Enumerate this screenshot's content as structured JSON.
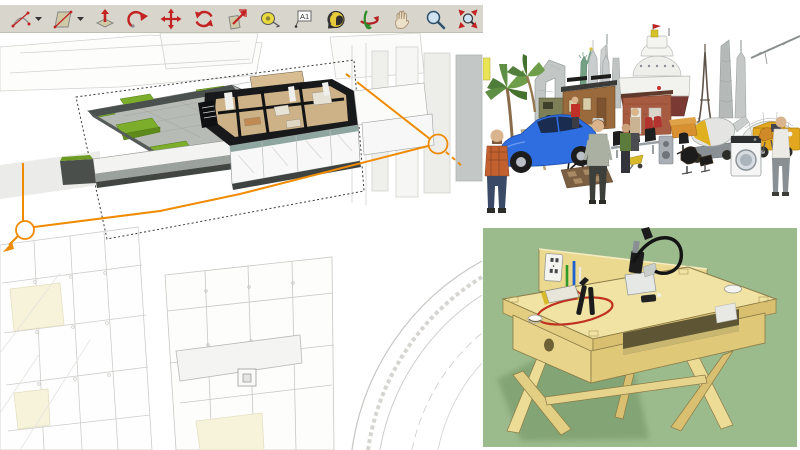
{
  "window": {
    "width": 800,
    "height": 450,
    "background": "#ffffff"
  },
  "left_panel": {
    "toolbar": {
      "background": "#d8d5cd",
      "text_tool_label": "A1",
      "tools": [
        {
          "name": "arc-tool",
          "dropdown": true
        },
        {
          "name": "shapes-tool",
          "dropdown": true
        },
        {
          "name": "push-pull-tool",
          "dropdown": false
        },
        {
          "name": "follow-me-tool",
          "dropdown": false
        },
        {
          "name": "move-tool",
          "dropdown": false
        },
        {
          "name": "rotate-tool",
          "dropdown": false
        },
        {
          "name": "scale-tool",
          "dropdown": false
        },
        {
          "name": "tape-measure-tool",
          "dropdown": false
        },
        {
          "name": "text-tool",
          "dropdown": false
        },
        {
          "name": "paint-bucket-tool",
          "dropdown": false
        },
        {
          "name": "orbit-tool",
          "dropdown": false
        },
        {
          "name": "pan-tool",
          "dropdown": false
        },
        {
          "name": "zoom-tool",
          "dropdown": false
        },
        {
          "name": "zoom-extents-tool",
          "dropdown": false
        }
      ]
    },
    "viewport": {
      "description": "architectural SketchUp model with active section cut",
      "colors": {
        "section_line_orange": "#ef8b00",
        "cut_wall_dark": "#17191b",
        "grass_green": "#7cae2c",
        "paving_gray": "#b7bbb5",
        "wood_floor": "#cdb187",
        "background_linework": "#cfcfcc",
        "pale_yellow": "#f6f3da"
      }
    }
  },
  "top_right_panel": {
    "description": "3D Warehouse model collage on white background",
    "items": [
      "palm trees",
      "CCTV tower",
      "military truck",
      "Statue of Liberty",
      "Petronas Towers",
      "skyscrapers",
      "wooden cabins",
      "cargo ship",
      "brick kiosk",
      "Eiffel Tower",
      "Shanghai towers",
      "lotus dome",
      "tower crane",
      "cement mixer truck",
      "yellow truck",
      "blue sports car",
      "plaid-shirt man",
      "elderly man",
      "green-shirt man",
      "white-shirt man",
      "trestle table",
      "director's chair",
      "checkered rug",
      "airport bench",
      "yellow cart",
      "speaker box",
      "red seats",
      "orange sofa",
      "office chair",
      "Eames lounge chair",
      "washing machine",
      "orange chair"
    ],
    "colors": {
      "car_blue": "#2e6ee0",
      "truck_yellow": "#e2a71f",
      "statue_green": "#74a183",
      "ship_hull_red": "#7a3a33",
      "background": "#ffffff"
    }
  },
  "bottom_right_panel": {
    "description": "plywood maker desk model on green background",
    "items": [
      "plywood desk",
      "back panel",
      "power outlet",
      "green pen",
      "blue pen",
      "red wire loop",
      "black clamps",
      "tool caddy",
      "black cable",
      "grommet holes",
      "open shelf slot",
      "splayed legs",
      "cast shadow"
    ],
    "colors": {
      "background_green": "#9cbb8d",
      "plywood_light": "#f0e3a4",
      "plywood_shade": "#d9c071",
      "shadow_green": "#7fa071",
      "wire_red": "#c03020"
    }
  }
}
